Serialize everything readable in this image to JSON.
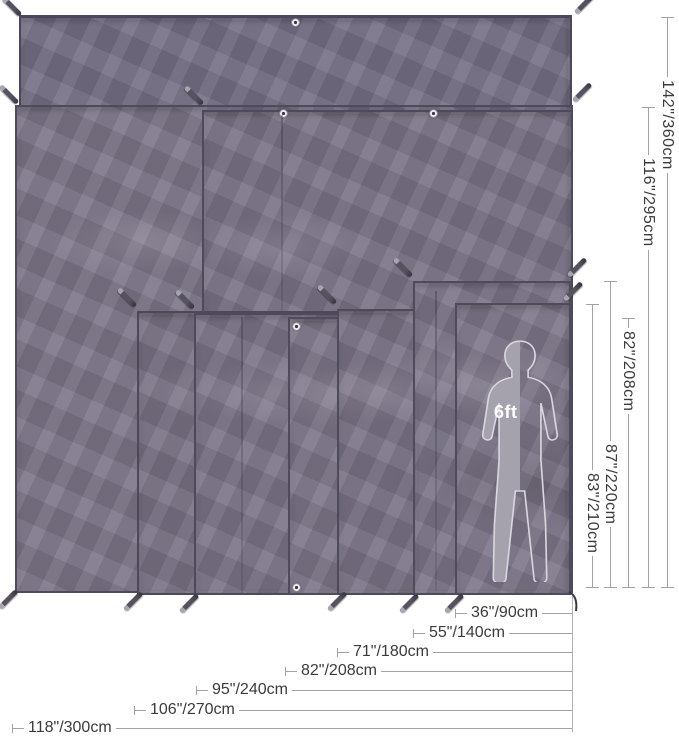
{
  "diagram": {
    "figure_scale_label": "6ft",
    "height_dimensions": [
      {
        "label": "142\"/360cm"
      },
      {
        "label": "116\"/295cm"
      },
      {
        "label": "82\"/208cm"
      },
      {
        "label": "87\"/220cm"
      },
      {
        "label": "83\"/210cm"
      }
    ],
    "width_dimensions": [
      {
        "label": "36\"/90cm"
      },
      {
        "label": "55\"/140cm"
      },
      {
        "label": "71\"/180cm"
      },
      {
        "label": "82\"/208cm"
      },
      {
        "label": "95\"/240cm"
      },
      {
        "label": "106\"/270cm"
      },
      {
        "label": "118\"/300cm"
      }
    ],
    "colors": {
      "tarp_base": "#7b7488",
      "tarp_hem": "#4f4a5e",
      "dimension_line": "#a2a2a2",
      "dimension_text": "#3b3b3b",
      "figure_fill": "#a5a1ad",
      "figure_label": "#ffffff",
      "background": "#ffffff"
    }
  }
}
